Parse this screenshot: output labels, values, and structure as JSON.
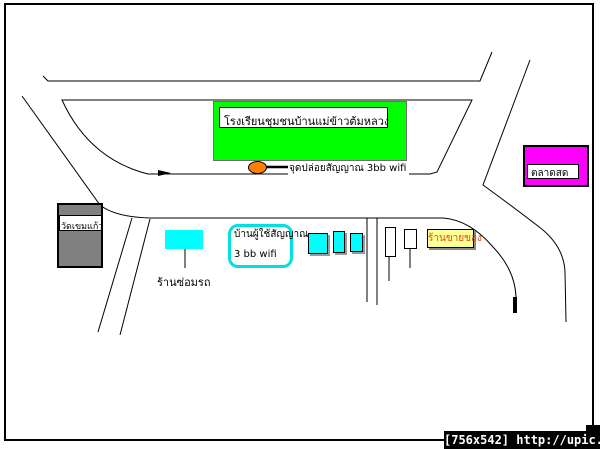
{
  "page": {
    "background": "#FFFFFF",
    "border_color": "#000000"
  },
  "map": {
    "school": {
      "label": "โรงเรียนชุมชนบ้านแม่ข้าวต้มหลวง",
      "fill": "#00FF00"
    },
    "wifi_point": {
      "label": "จุดปล่อยสัญญาณ 3bb wifi",
      "marker_fill": "#FF8000"
    },
    "market": {
      "label": "ตลาดสด",
      "fill": "#FF00FF"
    },
    "temple": {
      "label": "วัดเขมแก้ว",
      "fill": "#808080"
    },
    "repair_shop": {
      "label": "ร้านซ่อมรถ",
      "marker_fill": "#00FFFF"
    },
    "wifi_user_house": {
      "line1": "บ้านผู้ใช้สัญญาณ",
      "line2": "3 bb wifi",
      "border_color": "#00E0E0"
    },
    "goods_shop": {
      "label": "ร้านขายของ",
      "fill": "#FFFF99",
      "text_color": "#D4500A"
    },
    "house_markers": {
      "count": 3,
      "fill": "#00FFFF"
    },
    "sign_markers": {
      "count": 2,
      "fill": "#FFFFFF"
    },
    "road_color": "#000000"
  },
  "watermark": {
    "text": "[756x542] http://upic.me/"
  }
}
